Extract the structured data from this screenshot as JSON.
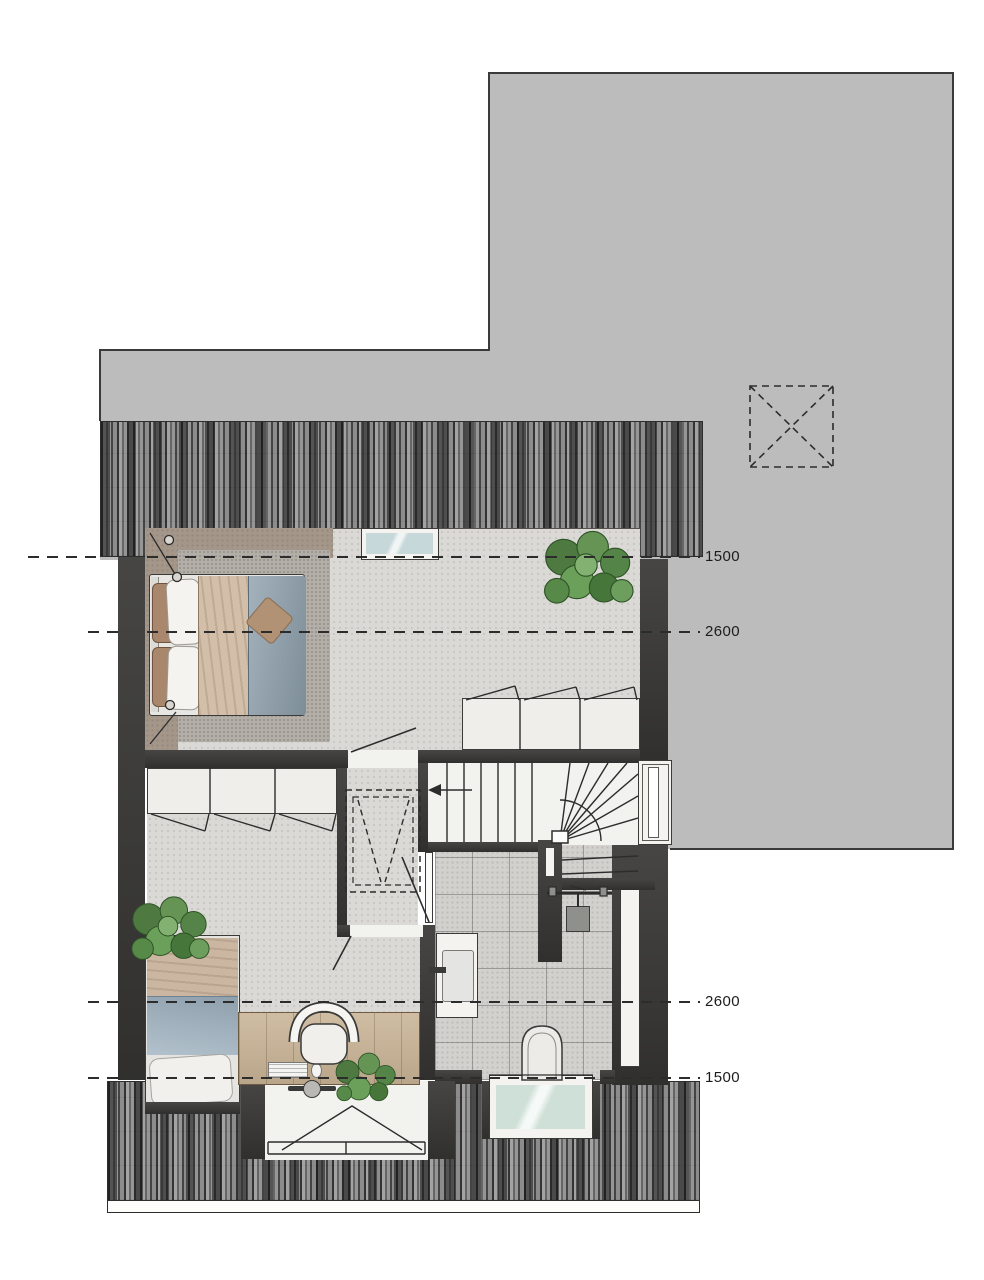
{
  "plan": {
    "title": "attic floor plan",
    "dimension_labels": [
      {
        "id": "headroom-line-1500-top",
        "text": "1500"
      },
      {
        "id": "headroom-line-2600-top",
        "text": "2600"
      },
      {
        "id": "headroom-line-2600-bottom",
        "text": "2600"
      },
      {
        "id": "headroom-line-1500-bottom",
        "text": "1500"
      }
    ],
    "colors": {
      "flat_roof_gray": "#bcbcbc",
      "tile_roof_base": "#8f8f8f",
      "wall_dark": "#3b3a38",
      "floor_light": "#dad9d5",
      "bathroom_tile": "#d2d1cd",
      "under_eave_taupe": "#a4978a",
      "duvet_blue": "#8fa1ad",
      "blanket_beige": "#d3bfa9",
      "desk_wood": "#c9b496",
      "plant_green": "#5e8c4e",
      "glass_blue": "#c6d8da",
      "line_dark": "#2c2c2c"
    }
  }
}
